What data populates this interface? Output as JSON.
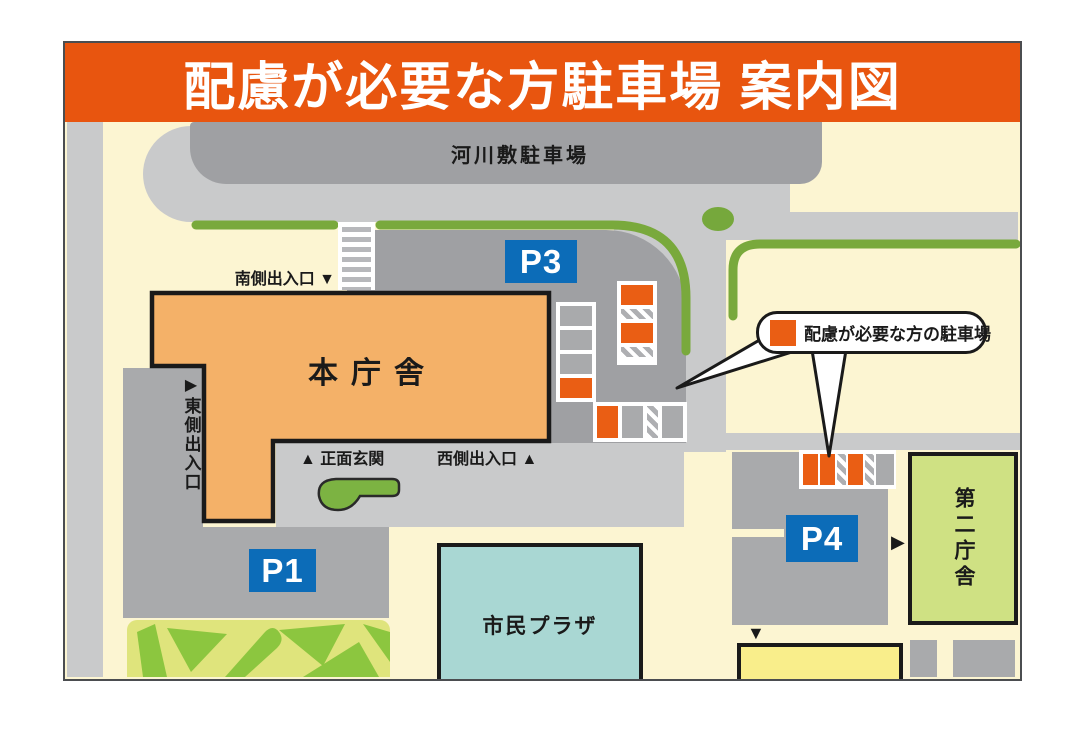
{
  "header": {
    "title": "配慮が必要な方駐車場 案内図"
  },
  "labels": {
    "riverbed_parking": "河川敷駐車場",
    "main_building": "本庁舎",
    "citizen_plaza": "市民プラザ",
    "second_building": "第二庁舎",
    "south_entrance": "南側出入口",
    "south_arrow": "▼",
    "east_arrow": "▶",
    "east_entrance": "東側出入口",
    "front_arrow": "▲",
    "front_entrance": "正面玄関",
    "west_entrance": "西側出入口",
    "west_arrow": "▲",
    "second_building_arrow": "▶",
    "south_exit_arrow": "▼"
  },
  "badges": {
    "p1": "P1",
    "p3": "P3",
    "p4": "P4"
  },
  "legend": {
    "text": "配慮が必要な方の駐車場"
  },
  "colors": {
    "header_orange": "#e8550f",
    "accessible_orange": "#ea5e14",
    "badge_blue": "#0c6cb8",
    "roadside_green": "#79a93c",
    "building_orange": "#f4b168",
    "plaza_teal": "#a9d7d3",
    "second_building_green": "#cfe183",
    "cream": "#fcf5d2"
  },
  "parking_cells": {
    "p3_side_column": [
      {
        "t": "gray",
        "s": 20
      },
      {
        "t": "gray",
        "s": 20
      },
      {
        "t": "gray",
        "s": 20
      },
      {
        "t": "orange",
        "s": 20
      }
    ],
    "p3_column": [
      {
        "t": "orange",
        "s": 20
      },
      {
        "t": "hatch",
        "s": 10
      },
      {
        "t": "orange",
        "s": 20
      },
      {
        "t": "hatch",
        "s": 10
      }
    ],
    "p3_row": [
      {
        "t": "orange",
        "s": 21
      },
      {
        "t": "gray",
        "s": 21
      },
      {
        "t": "hatch",
        "s": 11
      },
      {
        "t": "gray",
        "s": 21
      }
    ],
    "p4_row": [
      {
        "t": "orange",
        "s": 15
      },
      {
        "t": "orange",
        "s": 15
      },
      {
        "t": "hatch",
        "s": 9
      },
      {
        "t": "orange",
        "s": 15
      },
      {
        "t": "hatch",
        "s": 9
      },
      {
        "t": "gray",
        "s": 18
      }
    ]
  }
}
